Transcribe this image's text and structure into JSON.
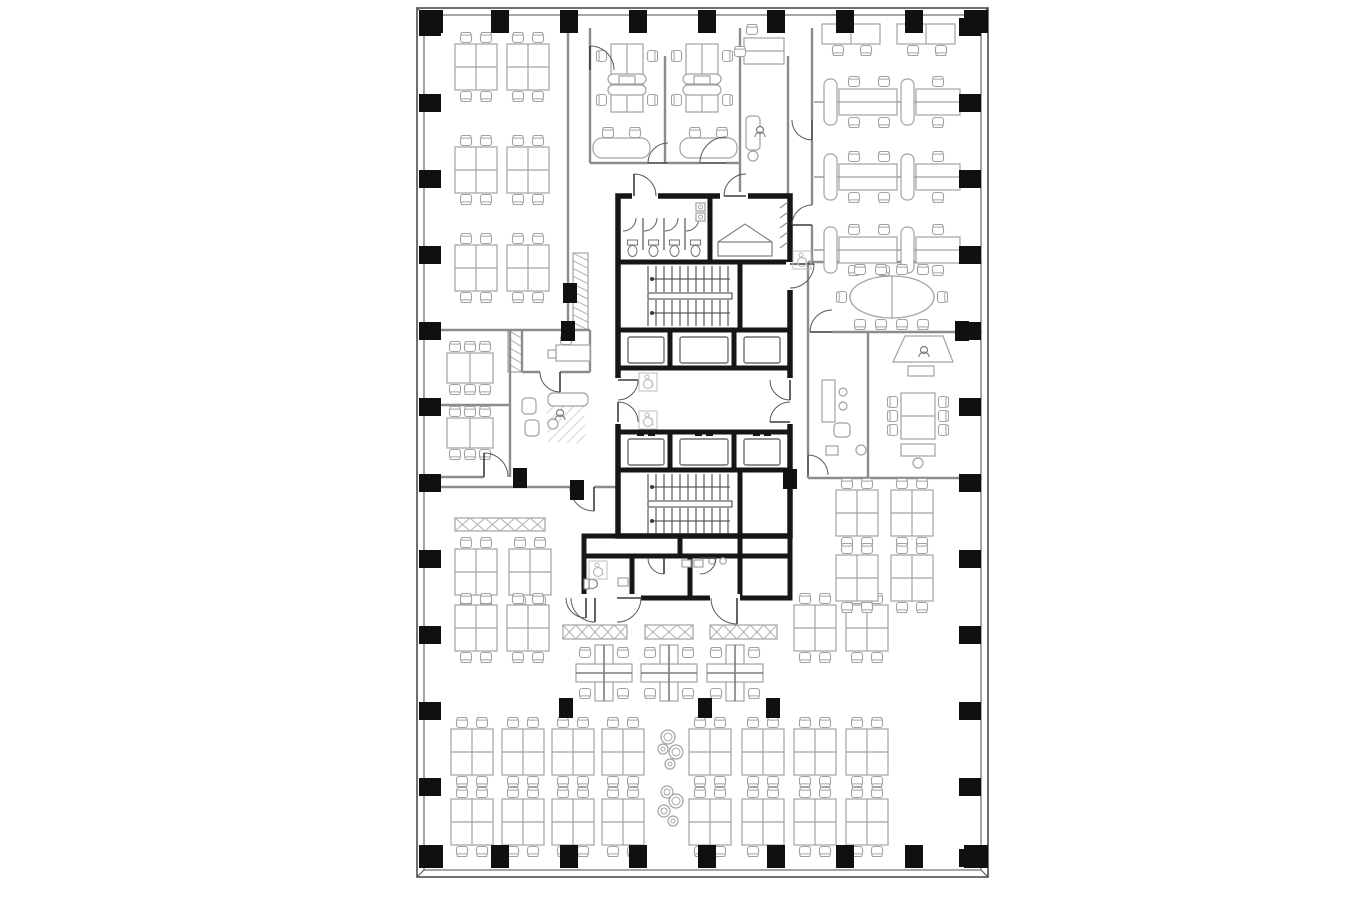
{
  "meta": {
    "description": "office-tower-typical-floor-plan",
    "visible_text": []
  },
  "palette": {
    "bg": "#ffffff",
    "shell": "#4d4d4d",
    "heavy_wall": "#161616",
    "partition": "#8c8c8c",
    "furniture": "#a2a2a2",
    "furniture_dark": "#7d7d7d",
    "door": "#5a5a5a",
    "tread": "#3a3a3a",
    "column": "#101010",
    "hatch": "#b0b0b0",
    "icon": "#bdbdbd"
  },
  "plan": {
    "x": 417,
    "y": 8,
    "w": 571,
    "h": 869,
    "inset": 7
  },
  "columns": {
    "top_x": [
      431,
      500,
      569,
      638,
      707,
      776,
      845,
      914,
      976
    ],
    "bottom_x": [
      431,
      500,
      569,
      638,
      707,
      776,
      845,
      914,
      976
    ],
    "left_y": [
      27,
      103,
      179,
      255,
      331,
      407,
      483,
      559,
      635,
      711,
      787,
      858
    ],
    "right_y": [
      27,
      103,
      179,
      255,
      331,
      407,
      483,
      559,
      635,
      711,
      787,
      858
    ],
    "interior": [
      [
        570,
        293
      ],
      [
        568,
        331
      ],
      [
        520,
        478
      ],
      [
        577,
        490
      ],
      [
        962,
        331
      ],
      [
        790,
        479
      ],
      [
        566,
        708
      ],
      [
        705,
        708
      ],
      [
        773,
        708
      ]
    ]
  },
  "partitions": [
    [
      568,
      28,
      568,
      330
    ],
    [
      437,
      330,
      590,
      330
    ],
    [
      510,
      330,
      510,
      477
    ],
    [
      437,
      405,
      510,
      405
    ],
    [
      437,
      477,
      484,
      477
    ],
    [
      522,
      330,
      522,
      372
    ],
    [
      590,
      330,
      590,
      372
    ],
    [
      522,
      372,
      540,
      372
    ],
    [
      560,
      372,
      590,
      372
    ],
    [
      437,
      487,
      570,
      487
    ],
    [
      594,
      487,
      618,
      487
    ],
    [
      590,
      28,
      590,
      163
    ],
    [
      740,
      28,
      740,
      196
    ],
    [
      788,
      56,
      788,
      196
    ],
    [
      665,
      56,
      665,
      163
    ],
    [
      590,
      163,
      648,
      163
    ],
    [
      668,
      163,
      700,
      163
    ],
    [
      726,
      163,
      740,
      163
    ],
    [
      812,
      28,
      812,
      120
    ],
    [
      812,
      140,
      812,
      205
    ],
    [
      812,
      225,
      812,
      262
    ],
    [
      808,
      262,
      982,
      262
    ],
    [
      808,
      262,
      808,
      455
    ],
    [
      808,
      475,
      808,
      478
    ],
    [
      832,
      332,
      982,
      332
    ],
    [
      868,
      332,
      868,
      478
    ],
    [
      808,
      478,
      982,
      478
    ]
  ],
  "hatches": [
    {
      "x": 573,
      "y": 253,
      "w": 15,
      "h": 77,
      "style": "zig"
    },
    {
      "x": 508,
      "y": 330,
      "w": 14,
      "h": 42,
      "style": "zig"
    },
    {
      "x": 455,
      "y": 518,
      "w": 90,
      "h": 13,
      "style": "x"
    },
    {
      "x": 563,
      "y": 625,
      "w": 64,
      "h": 14,
      "style": "x"
    },
    {
      "x": 645,
      "y": 625,
      "w": 48,
      "h": 14,
      "style": "x"
    },
    {
      "x": 710,
      "y": 625,
      "w": 67,
      "h": 14,
      "style": "x"
    }
  ],
  "core": {
    "outline": [
      618,
      196,
      172,
      340
    ],
    "bottom_block": [
      584,
      536,
      206,
      62
    ],
    "heavy_segments": [
      [
        618,
        262,
        790,
        262
      ],
      [
        710,
        196,
        710,
        262
      ],
      [
        618,
        330,
        790,
        330
      ],
      [
        618,
        368,
        790,
        368
      ],
      [
        618,
        432,
        790,
        432
      ],
      [
        618,
        470,
        790,
        470
      ],
      [
        618,
        536,
        790,
        536
      ],
      [
        670,
        330,
        670,
        368
      ],
      [
        734,
        330,
        734,
        368
      ],
      [
        670,
        432,
        670,
        470
      ],
      [
        734,
        432,
        734,
        470
      ],
      [
        740,
        262,
        740,
        330
      ],
      [
        740,
        470,
        740,
        536
      ],
      [
        680,
        536,
        680,
        556
      ],
      [
        740,
        536,
        740,
        556
      ],
      [
        632,
        556,
        632,
        598
      ],
      [
        690,
        556,
        690,
        598
      ],
      [
        740,
        556,
        740,
        598
      ],
      [
        584,
        556,
        788,
        556
      ]
    ],
    "door_gaps": [
      [
        614,
        378,
        8,
        46
      ],
      [
        786,
        378,
        8,
        46
      ],
      [
        786,
        262,
        8,
        28
      ],
      [
        575,
        594,
        66,
        8
      ],
      [
        710,
        594,
        30,
        8
      ],
      [
        632,
        192,
        26,
        8
      ],
      [
        720,
        192,
        28,
        8
      ]
    ],
    "stairs": [
      {
        "x": 640,
        "y": 264,
        "w": 100,
        "h": 64
      },
      {
        "x": 640,
        "y": 472,
        "w": 100,
        "h": 64
      }
    ],
    "elevators": {
      "cells": [
        [
          622,
          670
        ],
        [
          674,
          734
        ],
        [
          738,
          786
        ]
      ],
      "rows": [
        {
          "y": 332,
          "h": 36,
          "door": "bottom"
        },
        {
          "y": 434,
          "h": 36,
          "door": "top"
        }
      ]
    },
    "stalls": {
      "x_edges": [
        622,
        643,
        664,
        685,
        706
      ],
      "y_top": 218,
      "y_bot": 258
    },
    "sinks": [
      [
        696,
        203
      ],
      [
        696,
        213
      ]
    ],
    "bed": {
      "tent": [
        [
          718,
          242
        ],
        [
          745,
          224
        ],
        [
          772,
          242
        ]
      ],
      "rect": [
        718,
        242,
        54,
        14
      ]
    },
    "fold_hatch": {
      "x": 780,
      "y": 202,
      "h": 52
    },
    "wc_left": {
      "toilet": [
        592,
        584
      ],
      "fixture": [
        618,
        578,
        10,
        8
      ]
    },
    "urinals": [
      [
        682,
        560
      ],
      [
        694,
        560
      ]
    ],
    "wc_sinks": [
      [
        712,
        561
      ],
      [
        723,
        561
      ]
    ]
  },
  "doors": [
    [
      634,
      196,
      22,
      270,
      360
    ],
    [
      746,
      196,
      22,
      180,
      270
    ],
    [
      618,
      380,
      20,
      0,
      90
    ],
    [
      618,
      422,
      20,
      270,
      360
    ],
    [
      790,
      380,
      20,
      90,
      180
    ],
    [
      790,
      422,
      20,
      180,
      270
    ],
    [
      790,
      264,
      24,
      0,
      90
    ],
    [
      812,
      120,
      20,
      90,
      180
    ],
    [
      812,
      225,
      20,
      180,
      270
    ],
    [
      832,
      332,
      22,
      180,
      270
    ],
    [
      808,
      475,
      20,
      270,
      360
    ],
    [
      668,
      163,
      20,
      180,
      270
    ],
    [
      726,
      163,
      26,
      180,
      270
    ],
    [
      590,
      70,
      24,
      270,
      360
    ],
    [
      484,
      477,
      24,
      270,
      360
    ],
    [
      560,
      372,
      20,
      90,
      180
    ],
    [
      594,
      487,
      24,
      90,
      180
    ],
    [
      586,
      598,
      20,
      90,
      180
    ],
    [
      595,
      598,
      24,
      90,
      180
    ],
    [
      617,
      598,
      24,
      0,
      90
    ],
    [
      737,
      598,
      26,
      90,
      180
    ],
    [
      664,
      558,
      16,
      90,
      180
    ],
    [
      700,
      558,
      16,
      0,
      90
    ]
  ],
  "furniture": {
    "desk_clusters": [
      [
        476,
        67
      ],
      [
        528,
        67
      ],
      [
        476,
        170
      ],
      [
        528,
        170
      ],
      [
        476,
        268
      ],
      [
        528,
        268
      ],
      [
        476,
        572
      ],
      [
        530,
        572
      ],
      [
        476,
        628
      ],
      [
        528,
        628
      ],
      [
        815,
        628
      ],
      [
        867,
        628
      ],
      [
        472,
        752
      ],
      [
        523,
        752
      ],
      [
        573,
        752
      ],
      [
        623,
        752
      ],
      [
        710,
        752
      ],
      [
        763,
        752
      ],
      [
        815,
        752
      ],
      [
        867,
        752
      ],
      [
        472,
        822
      ],
      [
        523,
        822
      ],
      [
        573,
        822
      ],
      [
        623,
        822
      ],
      [
        710,
        822
      ],
      [
        763,
        822
      ],
      [
        815,
        822
      ],
      [
        867,
        822
      ],
      [
        857,
        513
      ],
      [
        912,
        513
      ],
      [
        857,
        578
      ],
      [
        912,
        578
      ]
    ],
    "cross_pods": [
      [
        604,
        673
      ],
      [
        669,
        673
      ],
      [
        735,
        673
      ]
    ],
    "bench_rows": [
      102,
      177,
      250
    ],
    "wall_desks": [
      [
        822,
        24
      ],
      [
        897,
        24
      ]
    ],
    "v_pods": [
      627,
      702
    ],
    "curved_desks": [
      593,
      680
    ],
    "meeting_tables": [
      [
        470,
        368
      ],
      [
        470,
        433
      ]
    ],
    "exec_table": [
      918,
      416
    ],
    "oval_table": [
      892,
      297
    ],
    "lounge_circles": [
      [
        668,
        737,
        7
      ],
      [
        663,
        749,
        5
      ],
      [
        676,
        752,
        7
      ],
      [
        670,
        764,
        5
      ],
      [
        667,
        792,
        6
      ],
      [
        676,
        801,
        7
      ],
      [
        664,
        811,
        6
      ],
      [
        673,
        821,
        5
      ]
    ],
    "sofa_group": {
      "sofa": [
        548,
        393,
        40,
        13
      ],
      "chairs": [
        [
          529,
          406
        ],
        [
          532,
          428
        ]
      ],
      "table": [
        553,
        424,
        5
      ],
      "person": [
        560,
        413
      ],
      "rug": [
        566,
        424
      ]
    },
    "reception": {
      "poly": "M893,362 L905,336 L943,336 L953,362 Z",
      "person": [
        924,
        350
      ],
      "small_rect": [
        908,
        366,
        26,
        10
      ]
    },
    "exec_left": {
      "credenza": [
        822,
        380,
        13,
        42
      ],
      "stools": [
        [
          843,
          392
        ],
        [
          843,
          406
        ]
      ],
      "armchair": [
        842,
        430,
        16,
        14
      ],
      "round": [
        861,
        450,
        5
      ],
      "small": [
        826,
        446,
        12,
        9
      ]
    },
    "exec_bottom": {
      "credenza": [
        901,
        444,
        34,
        12
      ],
      "stool": [
        918,
        463,
        5
      ]
    },
    "alcove": {
      "desk": [
        744,
        38,
        40,
        26
      ],
      "chairs": [
        [
          752,
          30
        ],
        [
          740,
          52
        ]
      ],
      "copier": [
        746,
        116,
        14,
        34
      ],
      "circle": [
        753,
        156,
        5
      ],
      "person": [
        760,
        130
      ]
    },
    "small_room_desk": {
      "rect": [
        556,
        345,
        34,
        16
      ],
      "sq": [
        548,
        350,
        8,
        8
      ],
      "chair": [
        566,
        340
      ]
    }
  },
  "icons": {
    "wheelchair": [
      [
        648,
        382
      ],
      [
        648,
        420
      ],
      [
        598,
        570
      ],
      [
        802,
        260
      ]
    ]
  }
}
